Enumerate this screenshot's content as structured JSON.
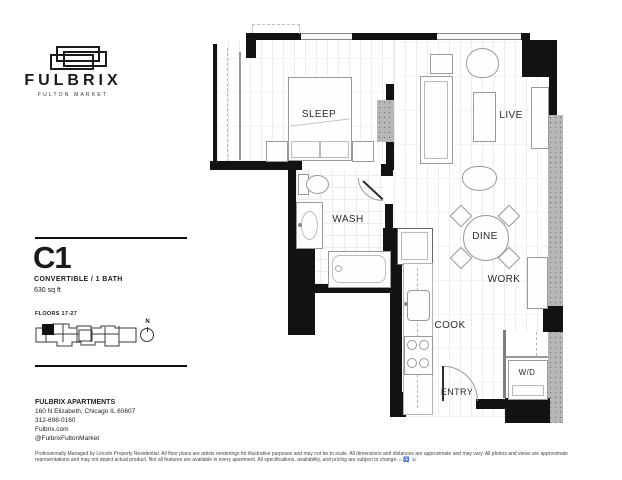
{
  "brand": {
    "name": "FULBRIX",
    "tagline": "FULTON MARKET"
  },
  "unit": {
    "name": "C1",
    "type": "CONVERTIBLE / 1 BATH",
    "area": "630 sq ft",
    "floors_label": "FLOORS 17-27",
    "compass_label": "N"
  },
  "rooms": {
    "sleep": "SLEEP",
    "live": "LIVE",
    "wash": "WASH",
    "dine": "DINE",
    "work": "WORK",
    "cook": "COOK",
    "entry": "ENTRY",
    "wd": "W/D"
  },
  "contact": {
    "name": "FULBRIX APARTMENTS",
    "address": "160 N Elizabeth, Chicago IL 60607",
    "phone": "312-698-0160",
    "website": "Fulbrix.com",
    "social": "@FulbrixFultonMarket"
  },
  "disclaimer": "Professionally Managed by Lincoln Property Residential. All floor plans are artists renderings for illustrative purposes and may not be to scale. All dimensions and distances are approximate and may vary. All photos and views are approximate representations and may not depict actual product. Not all features are available in every apartment. All specifications, availability, and pricing are subject to change. ⌂ ♿ ☏",
  "colors": {
    "wall": "#121212",
    "concrete": "#b6b6b6",
    "accent": "#1a1a1a"
  }
}
